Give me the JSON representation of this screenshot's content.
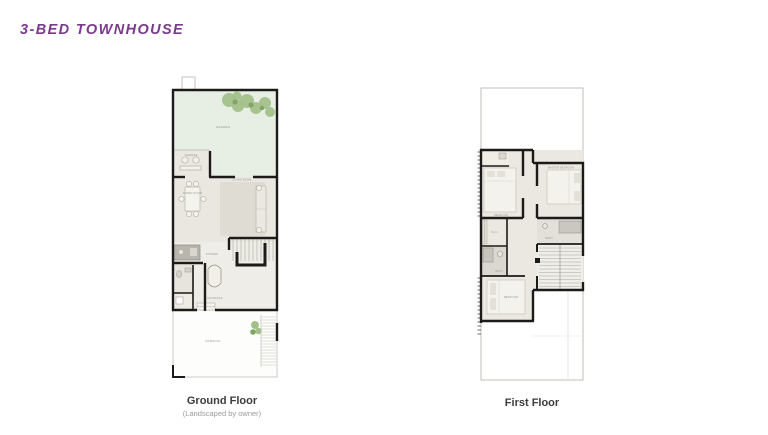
{
  "title": {
    "text": "3-BED TOWNHOUSE"
  },
  "colors": {
    "title": "#7b3b8c",
    "wall": "#1d1b19",
    "garden_green": "#e7eee3",
    "tree_green": "#a3c08b",
    "interior_beige": "#e9e7e0",
    "tile_gray": "#d9d7d0",
    "parking_white": "#fdfdfb",
    "caption_dark": "#3c3c3c",
    "caption_gray": "#9b9b9b"
  },
  "ground_floor": {
    "caption": "Ground Floor",
    "subcaption": "(Landscaped by owner)",
    "labels": {
      "garden": "GARDEN",
      "terrace": "TERRACE",
      "living": "LIVING ROOM",
      "dining": "DINING ROOM",
      "kitchen": "KITCHEN",
      "entrance": "ENTRANCE",
      "parking": "PARKING"
    }
  },
  "first_floor": {
    "caption": "First Floor",
    "labels": {
      "bedroom_1": "BEDROOM",
      "master_bedroom": "MASTER BEDROOM",
      "wic": "W.I.C",
      "bath_1": "BATH",
      "bath_2": "BATH",
      "bedroom_2": "BEDROOM"
    }
  }
}
